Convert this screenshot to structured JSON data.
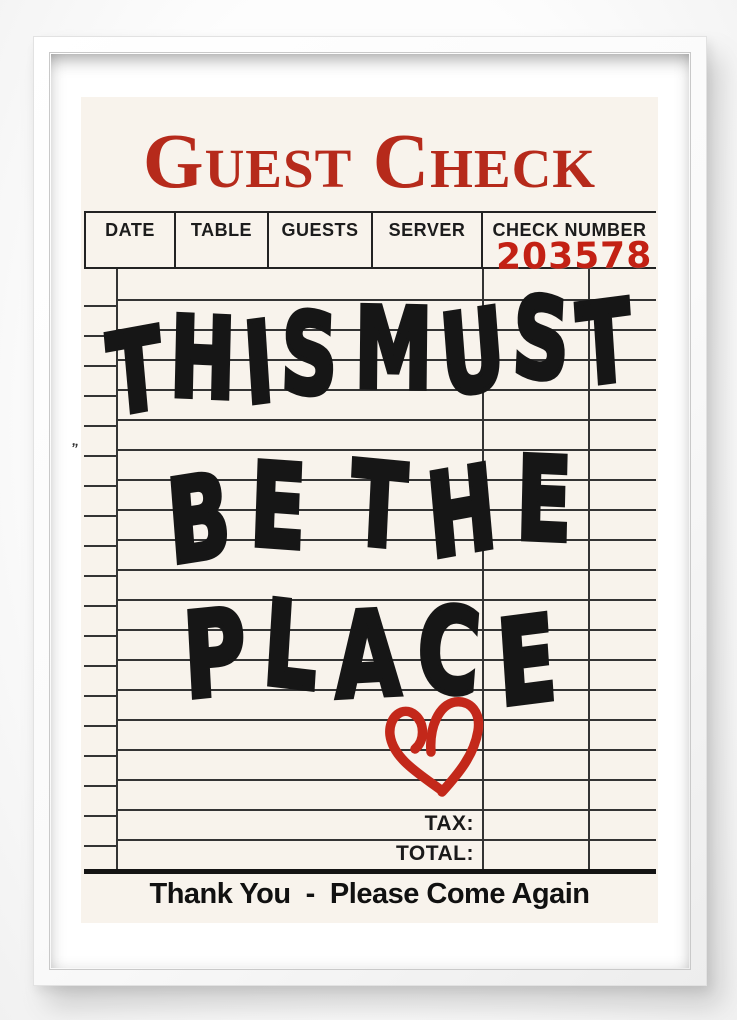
{
  "poster": {
    "title": "Guest Check",
    "header_columns": [
      "DATE",
      "TABLE",
      "GUESTS",
      "SERVER",
      "CHECK NUMBER"
    ],
    "check_number": "203578",
    "message_lines": [
      "THIS MUST",
      "BE THE",
      "PLACE"
    ],
    "tax_label": "TAX:",
    "total_label": "TOTAL:",
    "footer": "Thank You  -  Please Come Again",
    "smudge_mark": "”",
    "heart_icon": "hand-drawn-heart",
    "colors": {
      "paper": "#f8f3ec",
      "title_red": "#b62a1b",
      "stamp_red": "#c32114",
      "heart_red": "#c3281a",
      "ink": "#161616",
      "rule_line": "#343434",
      "mat": "#ffffff"
    }
  }
}
